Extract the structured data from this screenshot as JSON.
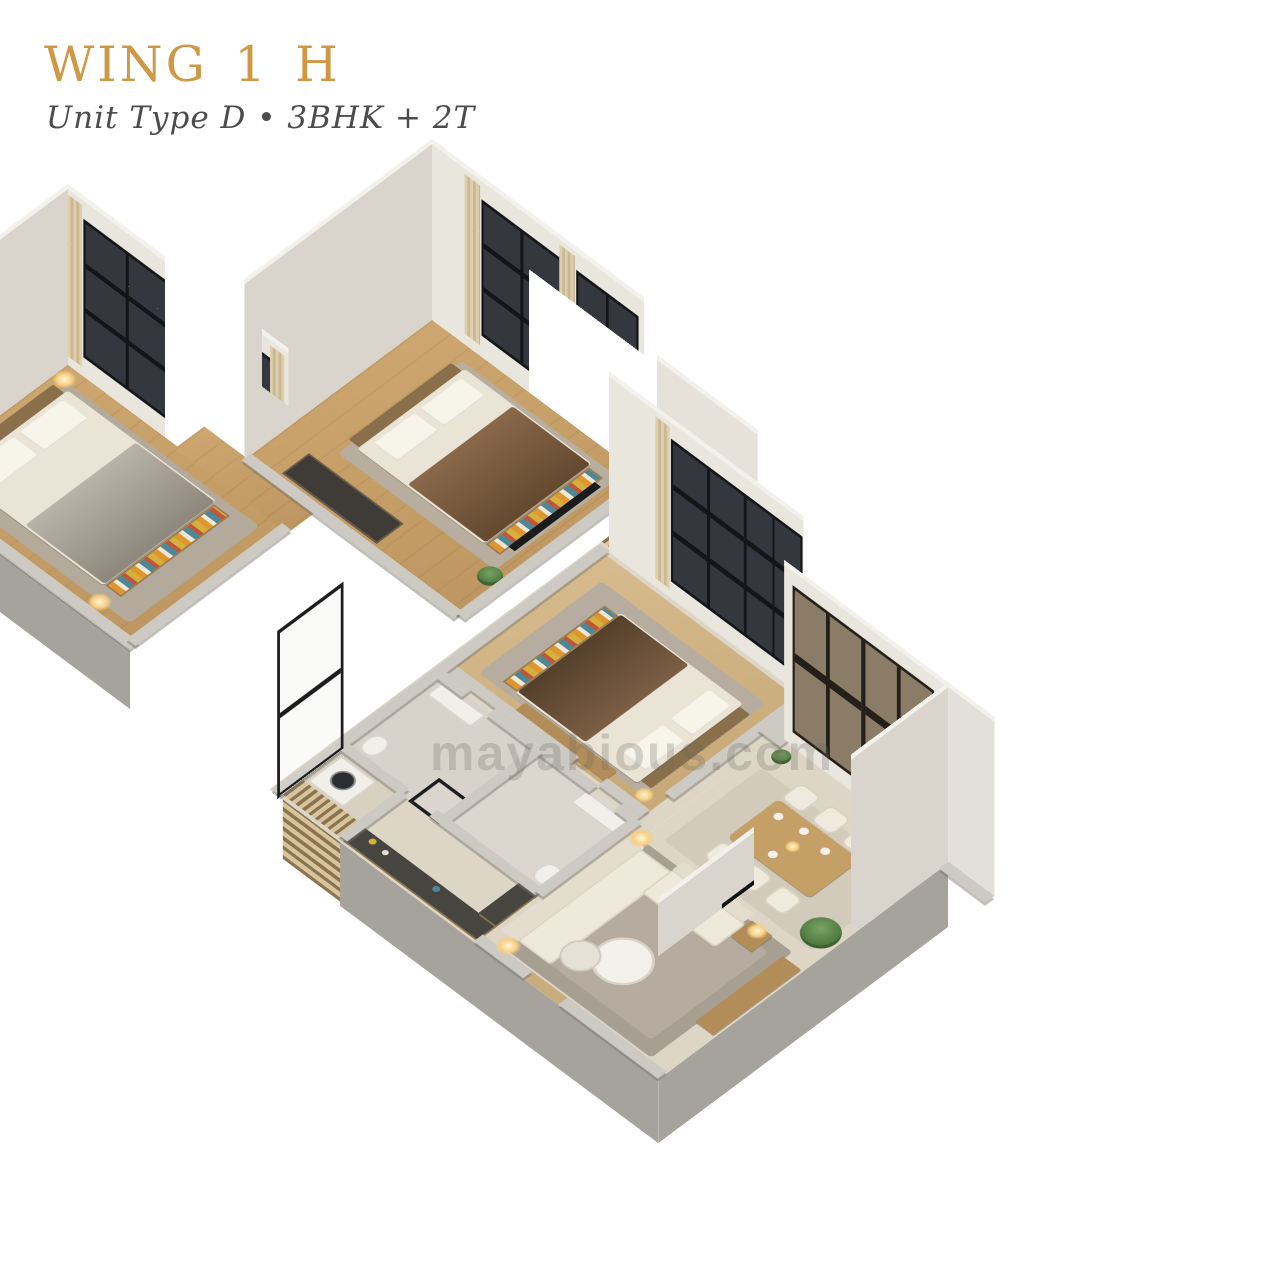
{
  "header": {
    "title": "WING 1 H",
    "subtitle": "Unit Type D • 3BHK + 2T"
  },
  "watermark": {
    "text": "mayabious.com"
  },
  "palette": {
    "background": "#ffffff",
    "title_gold": "#cf9844",
    "subtitle_gray": "#4c4c4c",
    "wall_light": "#e9e6de",
    "wall_shadow": "#b9b6b0",
    "window_glass_dark": "#34383e",
    "window_glass_bronze": "#8a7c66",
    "floor_wood": "#c5a06a",
    "floor_beige": "#ddd5c6",
    "rug_gray": "#a89f93"
  }
}
